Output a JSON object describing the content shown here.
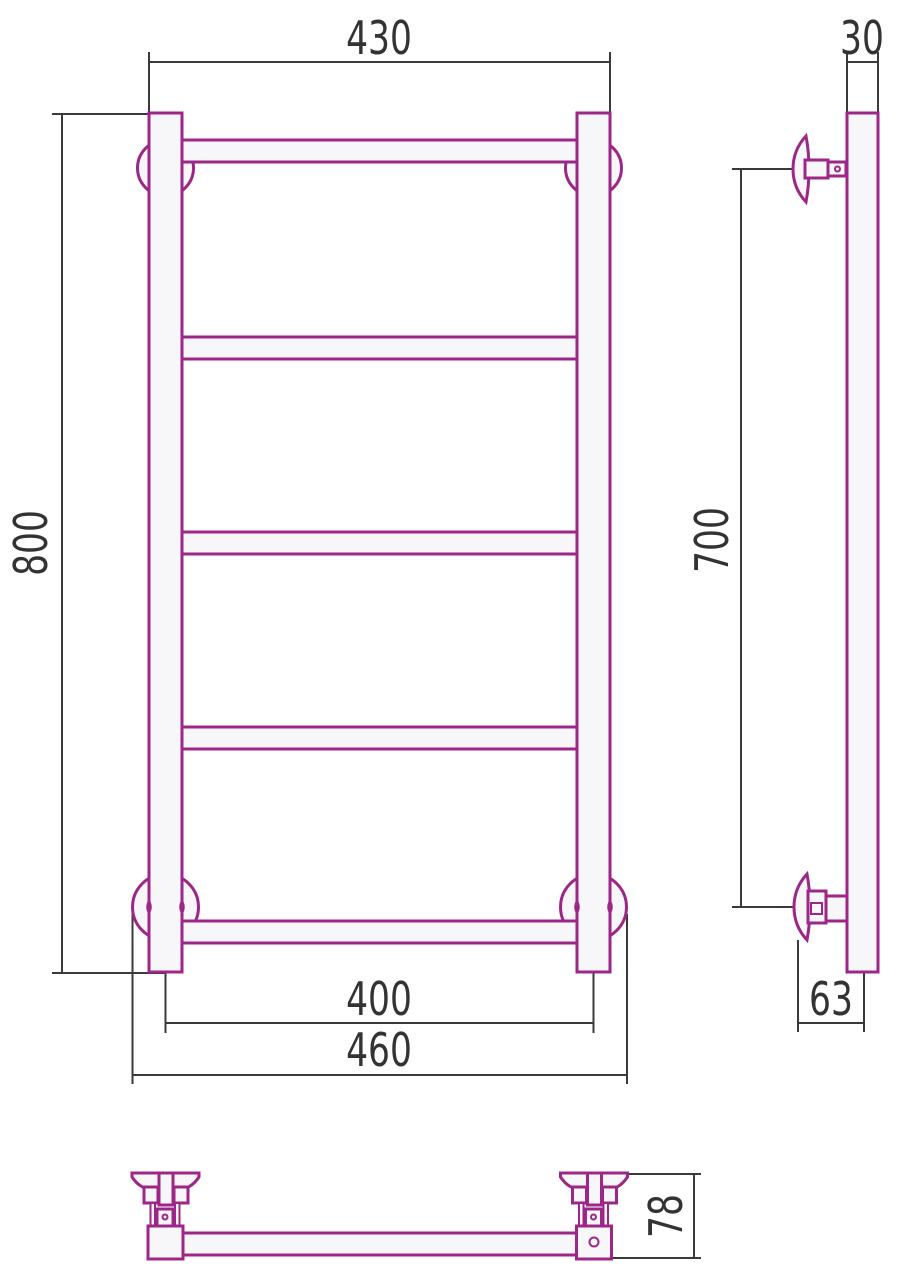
{
  "drawing": {
    "title": "towel-rail-technical-drawing",
    "colors": {
      "product_outline": "#9c2789",
      "product_fill": "#f7f6f8",
      "dimension_line": "#3a3a3a",
      "text": "#333333",
      "background": "#ffffff"
    },
    "views": {
      "front": {
        "rung_count": 5,
        "post_count": 2,
        "bracket_count": 4
      },
      "side": {
        "bracket_count": 2
      },
      "bottom": {
        "bracket_count": 2
      }
    },
    "dimensions": {
      "top_width": "430",
      "profile_width": "30",
      "overall_height": "800",
      "mount_spacing": "700",
      "post_center_width": "400",
      "overall_width": "460",
      "wall_to_post_center": "63",
      "bracket_depth": "78"
    }
  }
}
